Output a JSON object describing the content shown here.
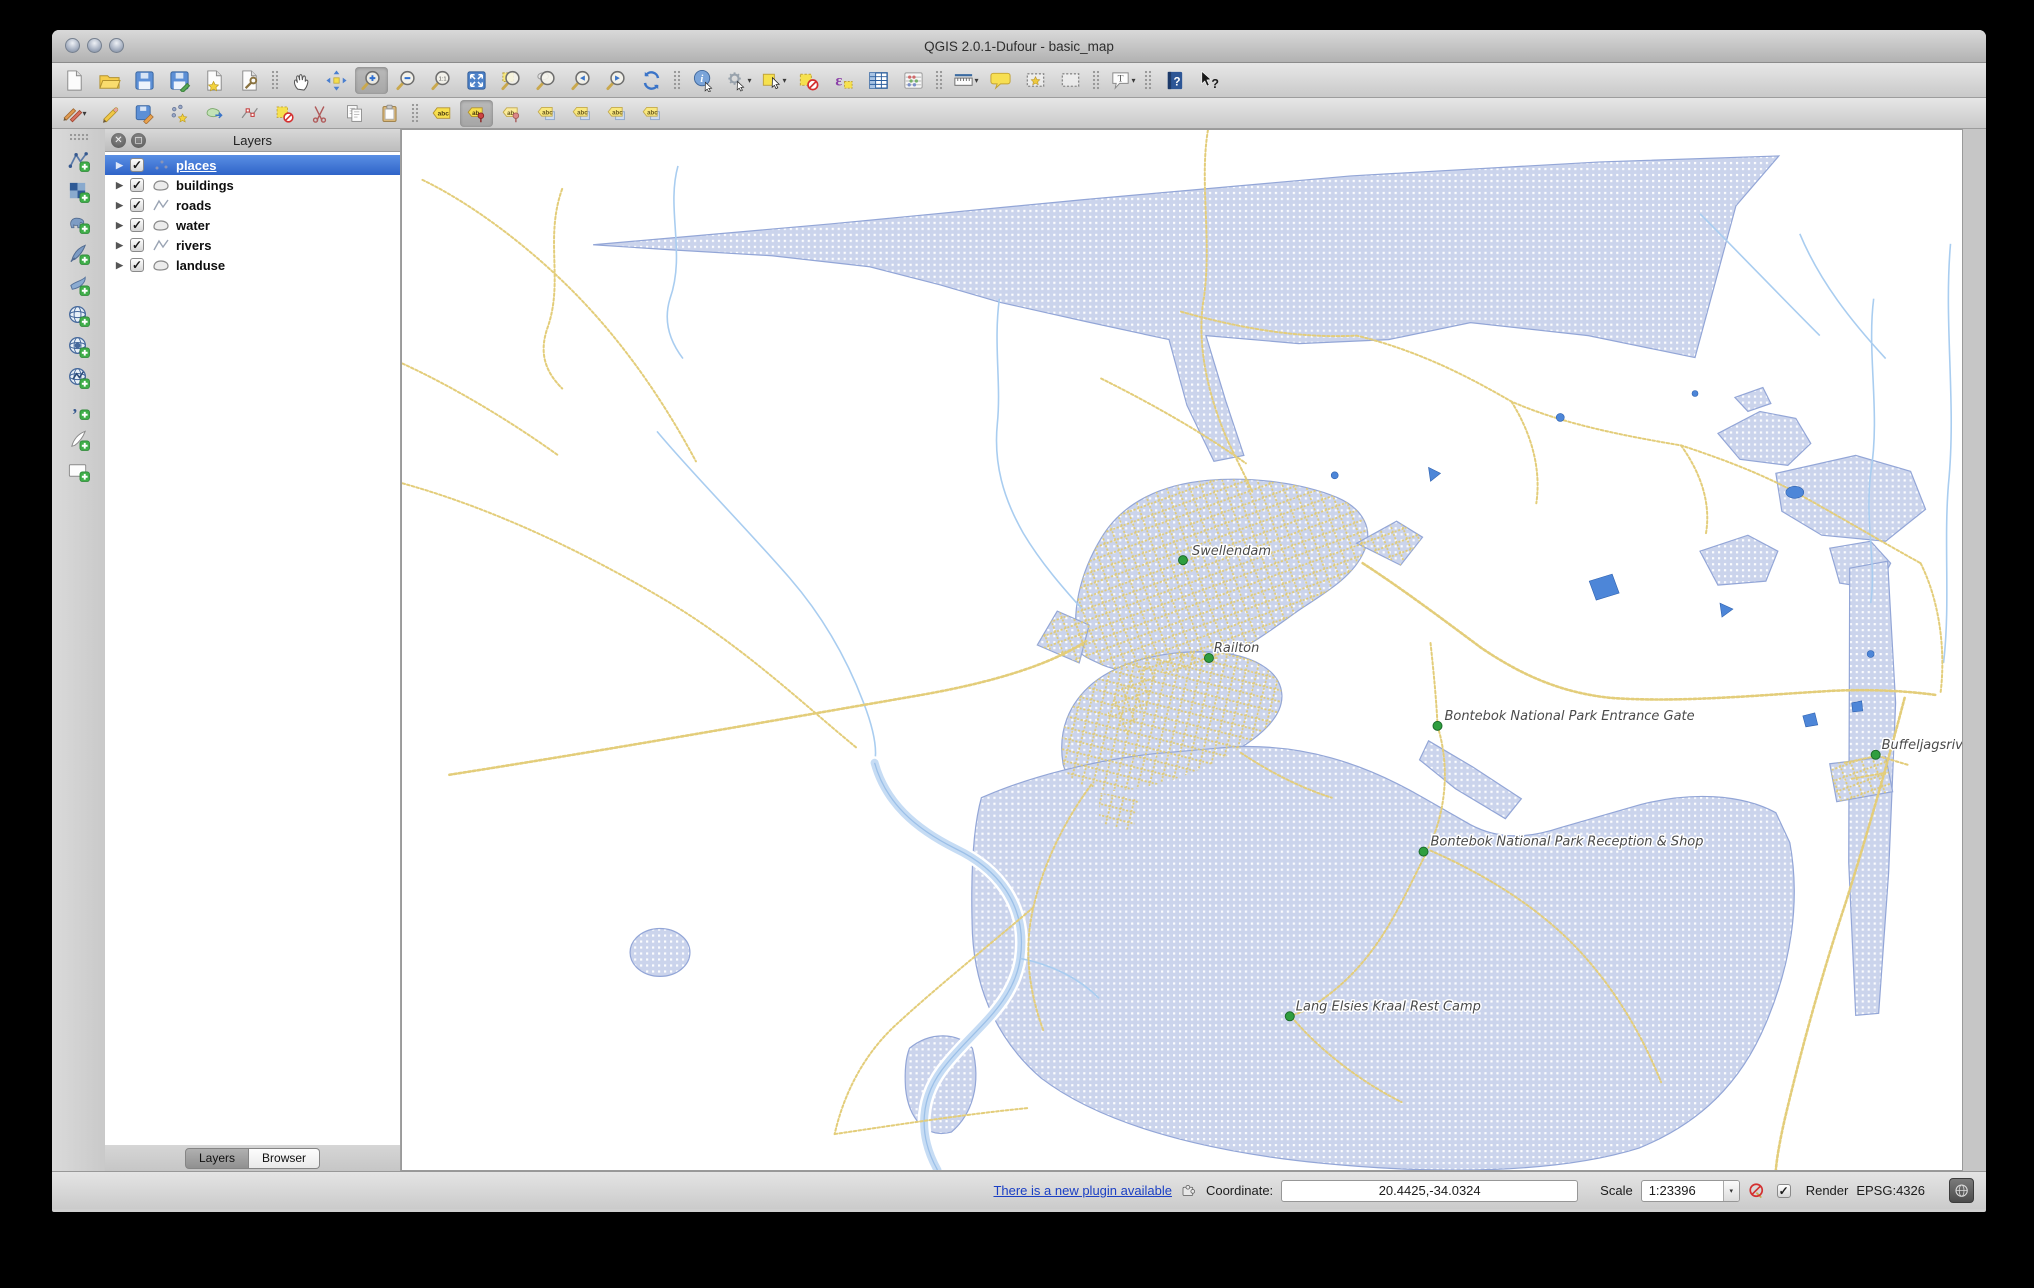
{
  "colors": {
    "selection_blue": "#3c76d2",
    "landuse_fill": "#cbd4ec",
    "landuse_border": "#93a6d7",
    "road_yellow": "#e3cd7a",
    "river_blue": "#a9cdf0",
    "water_blue": "#4d86d8",
    "place_dot_green": "#2f9e3f",
    "label_text": "#4a4a4a",
    "link_blue": "#1a3fc4"
  },
  "window": {
    "title": "QGIS 2.0.1-Dufour - basic_map",
    "traffic_lights": [
      "close",
      "minimize",
      "zoom"
    ]
  },
  "toolbars": {
    "row1": [
      {
        "name": "new-project",
        "sym": "page"
      },
      {
        "name": "open-project",
        "sym": "folder"
      },
      {
        "name": "save-project",
        "sym": "floppy"
      },
      {
        "name": "save-project-as",
        "sym": "floppy-edit"
      },
      {
        "name": "new-print-composer",
        "sym": "page-star"
      },
      {
        "name": "composer-manager",
        "sym": "page-wrench"
      },
      {
        "sep": true
      },
      {
        "name": "pan-map",
        "sym": "hand"
      },
      {
        "name": "pan-to-selection",
        "sym": "move"
      },
      {
        "name": "zoom-in",
        "sym": "mag-plus",
        "active": true
      },
      {
        "name": "zoom-out",
        "sym": "mag-minus"
      },
      {
        "name": "zoom-native",
        "sym": "mag-native"
      },
      {
        "name": "zoom-full",
        "sym": "full-extent"
      },
      {
        "name": "zoom-to-selection",
        "sym": "mag-selection"
      },
      {
        "name": "zoom-to-layer",
        "sym": "mag-layer"
      },
      {
        "name": "zoom-last",
        "sym": "mag-last"
      },
      {
        "name": "zoom-next",
        "sym": "mag-next"
      },
      {
        "name": "refresh-map",
        "sym": "refresh"
      },
      {
        "sep": true
      },
      {
        "name": "identify-features",
        "sym": "identify"
      },
      {
        "name": "run-feature-action",
        "sym": "gear",
        "dd": true
      },
      {
        "name": "select-features",
        "sym": "select",
        "dd": true
      },
      {
        "name": "deselect-all",
        "sym": "deselect"
      },
      {
        "name": "select-by-expression",
        "sym": "expression"
      },
      {
        "name": "open-attribute-table",
        "sym": "table"
      },
      {
        "name": "field-calculator",
        "sym": "abacus"
      },
      {
        "sep": true
      },
      {
        "name": "measure",
        "sym": "ruler",
        "dd": true
      },
      {
        "name": "map-tips",
        "sym": "bubble"
      },
      {
        "name": "new-bookmark",
        "sym": "bookmark-new"
      },
      {
        "name": "show-bookmarks",
        "sym": "bookmark"
      },
      {
        "sep": true
      },
      {
        "name": "text-annotation",
        "sym": "annotation",
        "dd": true
      },
      {
        "sep": true
      },
      {
        "name": "help",
        "sym": "help"
      },
      {
        "name": "whats-this",
        "sym": "whats-this"
      }
    ],
    "row2": [
      {
        "name": "current-edits",
        "sym": "pencils",
        "dd": true
      },
      {
        "name": "toggle-editing",
        "sym": "pencil"
      },
      {
        "name": "save-layer-edits",
        "sym": "floppy-pencil"
      },
      {
        "name": "add-feature",
        "sym": "add-feature"
      },
      {
        "name": "move-feature",
        "sym": "move-feature"
      },
      {
        "name": "node-tool",
        "sym": "node-tool"
      },
      {
        "name": "delete-selected",
        "sym": "delete-selected"
      },
      {
        "name": "cut-features",
        "sym": "cut"
      },
      {
        "name": "copy-features",
        "sym": "copy"
      },
      {
        "name": "paste-features",
        "sym": "paste"
      },
      {
        "sep": true
      },
      {
        "name": "labeling-options",
        "sym": "abc"
      },
      {
        "name": "pin-labels",
        "sym": "ab-pin",
        "active": true
      },
      {
        "name": "show-pinned-labels",
        "sym": "ab-pin2"
      },
      {
        "name": "highlight-label",
        "sym": "abc2"
      },
      {
        "name": "move-label",
        "sym": "abc2"
      },
      {
        "name": "rotate-label",
        "sym": "abc2"
      },
      {
        "name": "change-label-properties",
        "sym": "abc2"
      }
    ],
    "left": [
      {
        "name": "add-vector-layer",
        "sym": "vector-add"
      },
      {
        "name": "add-ra ster-layer",
        "sym": "raster-add"
      },
      {
        "name": "add-postgis-layer",
        "sym": "postgis-add"
      },
      {
        "name": "add-spatialite-layer",
        "sym": "spatialite-add"
      },
      {
        "name": "add-mssql-layer",
        "sym": "mssql-add"
      },
      {
        "name": "add-wms-layer",
        "sym": "wms-add"
      },
      {
        "name": "add-wcs-layer",
        "sym": "wcs-add"
      },
      {
        "name": "add-wfs-layer",
        "sym": "wfs-add"
      },
      {
        "name": "add-delimited-text-layer",
        "sym": "delimited-add"
      },
      {
        "name": "new-spatialite-layer",
        "sym": "new-spatialite"
      },
      {
        "name": "new-shapefile-layer",
        "sym": "new-shapefile"
      }
    ]
  },
  "layers_panel": {
    "title": "Layers",
    "layers": [
      {
        "label": "places",
        "geometry": "point",
        "checked": true,
        "selected": true
      },
      {
        "label": "buildings",
        "geometry": "polygon",
        "checked": true,
        "selected": false
      },
      {
        "label": "roads",
        "geometry": "line",
        "checked": true,
        "selected": false
      },
      {
        "label": "water",
        "geometry": "polygon",
        "checked": true,
        "selected": false
      },
      {
        "label": "rivers",
        "geometry": "line",
        "checked": true,
        "selected": false
      },
      {
        "label": "landuse",
        "geometry": "polygon",
        "checked": true,
        "selected": false
      }
    ],
    "tabs": [
      {
        "label": "Layers",
        "active": true
      },
      {
        "label": "Browser",
        "active": false
      }
    ]
  },
  "map": {
    "places": [
      {
        "name": "Swellendam",
        "dot_x": 1182,
        "dot_y": 557,
        "text_x": 1191,
        "text_y": 552
      },
      {
        "name": "Railton",
        "dot_x": 1208,
        "dot_y": 655,
        "text_x": 1213,
        "text_y": 649
      },
      {
        "name": "Bontebok National Park Entrance Gate",
        "dot_x": 1437,
        "dot_y": 723,
        "text_x": 1444,
        "text_y": 717
      },
      {
        "name": "Buffeljagsrivier",
        "dot_x": 1876,
        "dot_y": 752,
        "text_x": 1882,
        "text_y": 746
      },
      {
        "name": "Bontebok National Park Reception & Shop",
        "dot_x": 1423,
        "dot_y": 849,
        "text_x": 1430,
        "text_y": 843
      },
      {
        "name": "Lang Elsies Kraal Rest Camp",
        "dot_x": 1289,
        "dot_y": 1014,
        "text_x": 1295,
        "text_y": 1008
      }
    ]
  },
  "statusbar": {
    "plugin_update_link": "There is a new plugin available",
    "coordinate_label": "Coordinate:",
    "coordinate_value": "20.4425,-34.0324",
    "scale_label": "Scale",
    "scale_value": "1:23396",
    "render_label": "Render",
    "crs_label": "EPSG:4326"
  }
}
